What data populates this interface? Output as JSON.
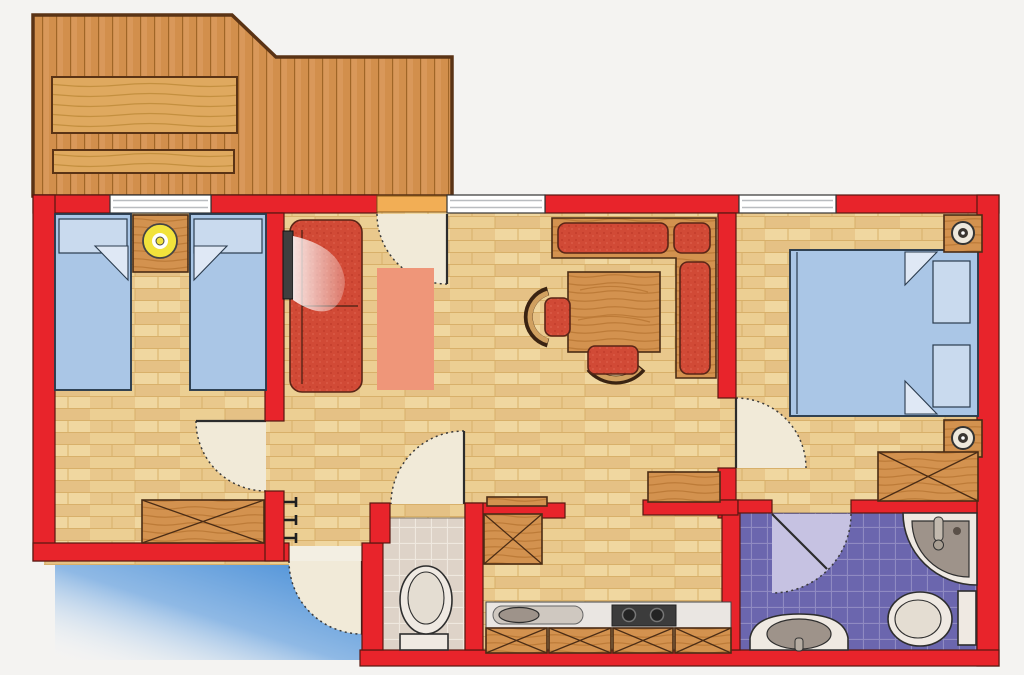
{
  "canvas": {
    "width": 1024,
    "height": 675
  },
  "colors": {
    "background": "#f4f3f1",
    "wall": "#e8242b",
    "wall_outline": "#571710",
    "floor_base": "#ecd096",
    "floor_line": "#d8b06a",
    "deck_base": "#d28f4c",
    "deck_line": "#9c6224",
    "bench_wood": "#dfa95f",
    "furniture_wood": "#d3924f",
    "furniture_wood_outline": "#4a2c15",
    "bed_blue": "#aac6e6",
    "bed_pillow": "#c9daee",
    "bed_outline": "#2a3b4d",
    "cushion_red": "#d14a36",
    "rug_salmon": "#ef9679",
    "door_swing": "#f1ead8",
    "door_line": "#3a3a3a",
    "window_white": "#ffffff",
    "balcony_door_orange": "#f2ae55",
    "wc_tile": "#ded3c8",
    "wc_tile_line": "#efe8df",
    "bath_tile": "#6b66ae",
    "bath_tile_line": "#8f8ac2",
    "bath_swing": "#c6c2e2",
    "fixture_white": "#efe9e2",
    "fixture_gray": "#9e938a",
    "counter_gray": "#eae6e2",
    "cooktop_dark": "#3c3c3c",
    "entry_blue": "#3f89d6",
    "lamp_yellow": "#f2e33c",
    "tv_dark": "#3f3f3f"
  },
  "floorplan": {
    "type": "apartment-floor-plan",
    "rooms": [
      {
        "name": "balcony-terrace",
        "furniture": [
          "wooden-table",
          "wooden-bench"
        ]
      },
      {
        "name": "twin-bedroom",
        "furniture": [
          "single-bed-left",
          "single-bed-right",
          "nightstand-with-lamp",
          "chest-of-drawers"
        ]
      },
      {
        "name": "living-dining-room",
        "furniture": [
          "sofa",
          "tv",
          "rug",
          "corner-bench",
          "dining-table",
          "chair-west",
          "chair-south",
          "sideboard",
          "wall-shelf"
        ]
      },
      {
        "name": "entry-hall",
        "furniture": [
          "coat-hooks"
        ]
      },
      {
        "name": "wc",
        "furniture": [
          "toilet"
        ]
      },
      {
        "name": "kitchen",
        "furniture": [
          "tall-cabinet",
          "counter",
          "sink",
          "cooktop",
          "base-cabinets"
        ]
      },
      {
        "name": "bathroom",
        "furniture": [
          "corner-shower",
          "washbasin",
          "toilet"
        ]
      },
      {
        "name": "double-bedroom",
        "furniture": [
          "double-bed",
          "nightstand-top",
          "nightstand-bottom",
          "wardrobe"
        ]
      }
    ],
    "windows_count": 3,
    "doors": [
      "front-door",
      "balcony-door",
      "twin-bedroom-door",
      "double-bedroom-door",
      "wc-door",
      "bathroom-door"
    ]
  }
}
